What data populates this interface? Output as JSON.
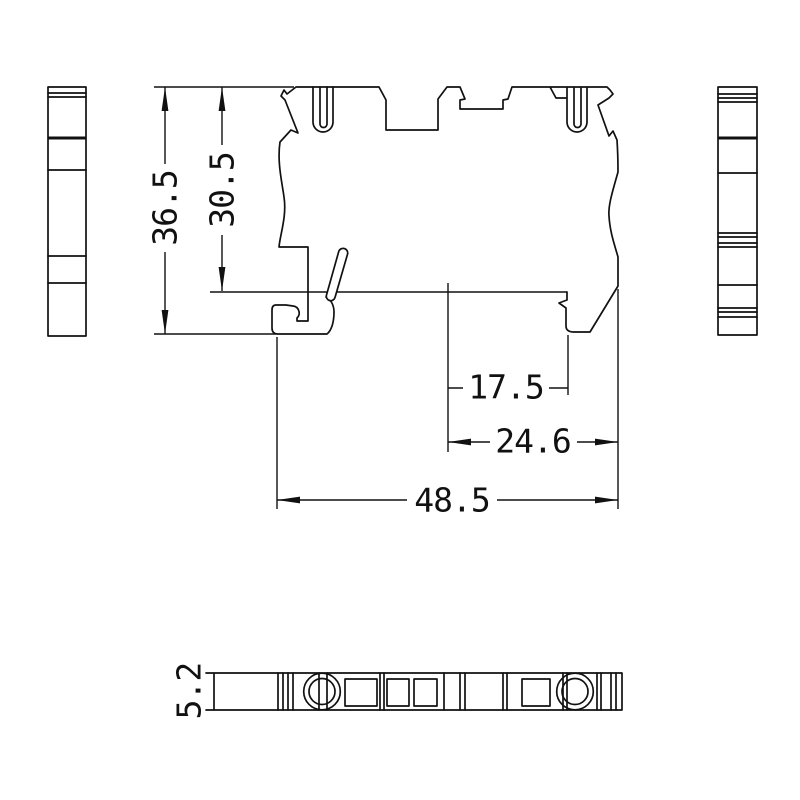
{
  "colors": {
    "line": "#111111",
    "background": "#ffffff"
  },
  "dimensions": {
    "overall_height": "36.5",
    "height_above_rail": "30.5",
    "center_to_latch": "17.5",
    "center_to_right_edge": "24.6",
    "overall_width": "48.5",
    "strip_thickness": "5.2"
  }
}
